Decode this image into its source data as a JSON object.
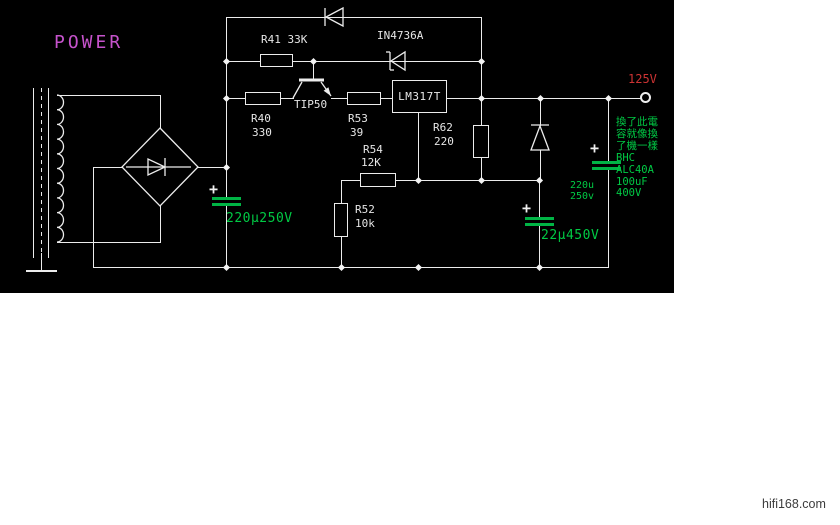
{
  "title": "POWER",
  "watermark": "hifi168.com",
  "schematic": {
    "output_terminal": {
      "label": "125V"
    },
    "components": {
      "r41": {
        "label": "R41 33K"
      },
      "r40": {
        "designator": "R40",
        "value": "330"
      },
      "r53": {
        "designator": "R53",
        "value": "39"
      },
      "r54": {
        "designator": "R54",
        "value": "12K"
      },
      "r52": {
        "designator": "R52",
        "value": "10k"
      },
      "r62": {
        "designator": "R62",
        "value": "220"
      },
      "zener": {
        "label": "IN4736A"
      },
      "transistor": {
        "label": "TIP50"
      },
      "regulator": {
        "label": "LM317T"
      },
      "cap_main": {
        "label": "220µ250V",
        "plus": "+"
      },
      "cap_out": {
        "label": "22µ450V",
        "plus": "+"
      },
      "cap_bhc": {
        "label_top": "220u",
        "label_bottom": "250v",
        "plus": "+"
      },
      "annotation": {
        "lines": [
          "換了此電",
          "容就像換",
          "了機一樣",
          "BHC",
          "ALC40A",
          "100uF",
          "400V"
        ]
      }
    },
    "colors": {
      "background": "#000000",
      "wire": "#ececec",
      "green": "#00c944",
      "red": "#cd3333",
      "magenta": "#c653cc"
    }
  }
}
